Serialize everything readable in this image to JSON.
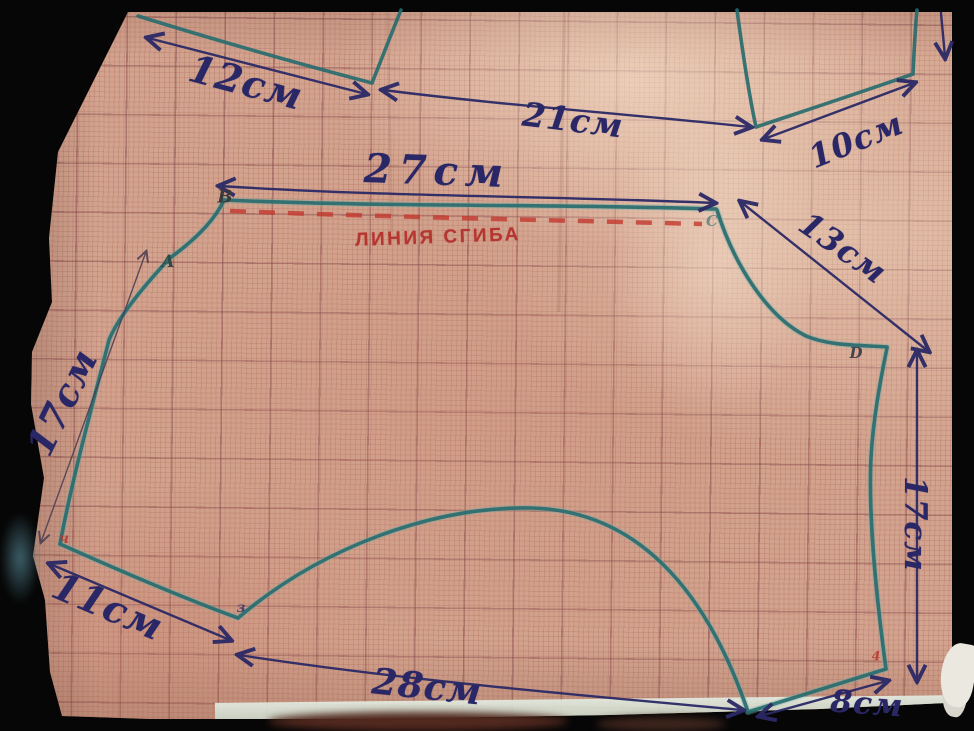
{
  "scene": {
    "description": "Photo of a hand-drawn pet-clothing sewing pattern on pink millimeter graph paper",
    "paper_color": "#d2a48f",
    "outline_ink": "#266b6e",
    "measure_ink": "#2a2766",
    "fold_ink": "#b5352f"
  },
  "fold_line": {
    "label": "ЛИНИЯ СГИБА",
    "style": "red dashed"
  },
  "measurements": [
    {
      "id": "upper-piece-left-edge",
      "text": "12см"
    },
    {
      "id": "upper-piece-mid-edge",
      "text": "21см"
    },
    {
      "id": "upper-piece-right-edge",
      "text": "10см"
    },
    {
      "id": "back-top-edge",
      "text": "27см"
    },
    {
      "id": "neck-slant",
      "text": "13см"
    },
    {
      "id": "left-side",
      "text": "17см"
    },
    {
      "id": "bottom-left-edge",
      "text": "11см"
    },
    {
      "id": "bottom-edge",
      "text": "28см"
    },
    {
      "id": "bottom-right-edge",
      "text": "8см"
    },
    {
      "id": "right-side",
      "text": "17см"
    }
  ],
  "point_labels": [
    {
      "id": "A",
      "text": "A"
    },
    {
      "id": "B",
      "text": "B"
    },
    {
      "id": "C",
      "text": "C"
    },
    {
      "id": "D",
      "text": "D"
    },
    {
      "id": "3",
      "text": "з"
    },
    {
      "id": "4-left",
      "text": "ч"
    },
    {
      "id": "4-right",
      "text": "4"
    }
  ]
}
